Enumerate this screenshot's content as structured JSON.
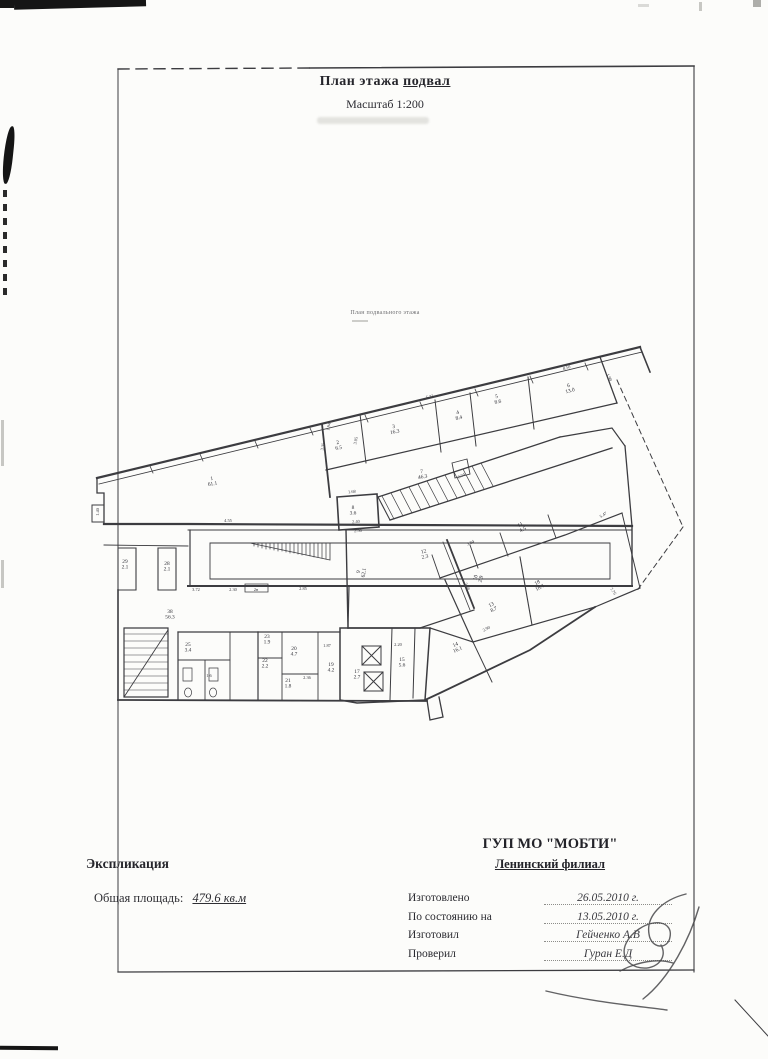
{
  "header": {
    "title_main": "План этажа",
    "title_floor": "подвал",
    "scale": "Масштаб 1:200",
    "plan_caption": "План подвального этажа"
  },
  "footer": {
    "explication": "Экспликация",
    "total_area_label": "Общая площадь:",
    "total_area_value": "479.6 кв.м",
    "org": "ГУП МО \"МОБТИ\"",
    "branch": "Ленинский филиал",
    "rows": [
      {
        "label": "Изготовлено",
        "value": "26.05.2010 г."
      },
      {
        "label": "По состоянию на",
        "value": "13.05.2010 г."
      },
      {
        "label": "Изготовил",
        "value": "Гейченко А.В"
      },
      {
        "label": "Проверил",
        "value": "Гуран Е.Д"
      }
    ]
  },
  "plan": {
    "rooms": [
      {
        "n": "1",
        "a": "61.1",
        "x": 212,
        "y": 480,
        "r": -8
      },
      {
        "n": "2",
        "a": "6.5",
        "x": 338,
        "y": 444,
        "r": -10
      },
      {
        "n": "3",
        "a": "16.3",
        "x": 394,
        "y": 428,
        "r": -11
      },
      {
        "n": "4",
        "a": "8.4",
        "x": 458,
        "y": 414,
        "r": -12
      },
      {
        "n": "5",
        "a": "8.6",
        "x": 497,
        "y": 398,
        "r": -13
      },
      {
        "n": "6",
        "a": "13.0",
        "x": 569,
        "y": 387,
        "r": -15
      },
      {
        "n": "7",
        "a": "46.3",
        "x": 422,
        "y": 473,
        "r": -10
      },
      {
        "n": "8",
        "a": "3.6",
        "x": 353,
        "y": 509,
        "r": 0
      },
      {
        "n": "9",
        "a": "62.1",
        "x": 360,
        "y": 572,
        "r": -80
      },
      {
        "n": "10",
        "a": "2.9",
        "x": 477,
        "y": 578,
        "r": -75
      },
      {
        "n": "11",
        "a": "4.5",
        "x": 521,
        "y": 526,
        "r": -28
      },
      {
        "n": "12",
        "a": "2.3",
        "x": 424,
        "y": 553,
        "r": -14
      },
      {
        "n": "13",
        "a": "8.7",
        "x": 492,
        "y": 606,
        "r": -28
      },
      {
        "n": "14",
        "a": "16.1",
        "x": 456,
        "y": 646,
        "r": -24
      },
      {
        "n": "18",
        "a": "18.1",
        "x": 538,
        "y": 584,
        "r": -28
      },
      {
        "n": "15",
        "a": "5.6",
        "x": 402,
        "y": 661,
        "r": 0
      },
      {
        "n": "17",
        "a": "2.7",
        "x": 357,
        "y": 673,
        "r": 0
      },
      {
        "n": "19",
        "a": "4.2",
        "x": 331,
        "y": 666,
        "r": 0
      },
      {
        "n": "20",
        "a": "4.7",
        "x": 294,
        "y": 650,
        "r": 0
      },
      {
        "n": "21",
        "a": "1.8",
        "x": 288,
        "y": 682,
        "r": 0
      },
      {
        "n": "22",
        "a": "2.2",
        "x": 265,
        "y": 662,
        "r": 0
      },
      {
        "n": "23",
        "a": "1.9",
        "x": 267,
        "y": 638,
        "r": 0
      },
      {
        "n": "25",
        "a": "3.4",
        "x": 188,
        "y": 646,
        "r": 0
      },
      {
        "n": "28",
        "a": "2.1",
        "x": 167,
        "y": 565,
        "r": 0
      },
      {
        "n": "29",
        "a": "2.1",
        "x": 125,
        "y": 563,
        "r": 0
      },
      {
        "n": "38",
        "a": "56.3",
        "x": 170,
        "y": 613,
        "r": 0
      }
    ],
    "dims": [
      {
        "t": "1.40",
        "x": 99,
        "y": 512,
        "r": -88
      },
      {
        "t": "4.55",
        "x": 228,
        "y": 522,
        "r": 0
      },
      {
        "t": "3.72",
        "x": 196,
        "y": 591,
        "r": 0
      },
      {
        "t": "2.30",
        "x": 233,
        "y": 591,
        "r": 0
      },
      {
        "t": "2н",
        "x": 256,
        "y": 591,
        "r": 0
      },
      {
        "t": "2.85",
        "x": 303,
        "y": 590,
        "r": 0
      },
      {
        "t": "1.94",
        "x": 330,
        "y": 427,
        "r": -78
      },
      {
        "t": "3.35",
        "x": 324,
        "y": 447,
        "r": -78
      },
      {
        "t": "3.05",
        "x": 357,
        "y": 441,
        "r": -78
      },
      {
        "t": "1.68",
        "x": 352,
        "y": 493,
        "r": -5
      },
      {
        "t": "2.40",
        "x": 356,
        "y": 523,
        "r": -3
      },
      {
        "t": "2.56",
        "x": 358,
        "y": 532,
        "r": -3
      },
      {
        "t": "8.04",
        "x": 462,
        "y": 477,
        "r": -27
      },
      {
        "t": "5.32",
        "x": 430,
        "y": 398,
        "r": -13
      },
      {
        "t": "8.50",
        "x": 567,
        "y": 369,
        "r": -17
      },
      {
        "t": "1.90",
        "x": 608,
        "y": 378,
        "r": 62
      },
      {
        "t": "3.84",
        "x": 471,
        "y": 544,
        "r": -25
      },
      {
        "t": "5.47",
        "x": 604,
        "y": 516,
        "r": -33
      },
      {
        "t": "3.88",
        "x": 466,
        "y": 587,
        "r": 62
      },
      {
        "t": "7.76",
        "x": 612,
        "y": 592,
        "r": 55
      },
      {
        "t": "2.90",
        "x": 487,
        "y": 630,
        "r": -28
      },
      {
        "t": "2.20",
        "x": 398,
        "y": 646,
        "r": 0
      },
      {
        "t": "1.87",
        "x": 327,
        "y": 647,
        "r": 0
      },
      {
        "t": "2.36",
        "x": 307,
        "y": 679,
        "r": 0
      },
      {
        "t": "1.6",
        "x": 209,
        "y": 677,
        "r": 0
      }
    ],
    "walls": [
      {
        "d": "M118,69 L310,68",
        "w": 1.4,
        "dash": "11,7",
        "c": "#585858"
      },
      {
        "d": "M310,68 L694,66",
        "w": 1.6,
        "c": "#4c4c4c"
      },
      {
        "d": "M694,66 L694,972",
        "w": 1.1,
        "c": "#7a7a78"
      },
      {
        "d": "M118,69 L118,972",
        "w": 1,
        "c": "#b8b8b4"
      },
      {
        "d": "M118,972 L694,970",
        "w": 1.3,
        "c": "#565656"
      },
      {
        "d": "M97,478 L640,347",
        "w": 2.2
      },
      {
        "d": "M99,484 L642,352",
        "w": 0.9
      },
      {
        "d": "M150,466 l3,7 M200,454 l3,7 M255,441 l3,7 M310,428 l3,7 M365,415 l3,7 M420,402 l3,7 M475,389 l3,7 M530,376 l3,7 M585,363 l3,7",
        "w": 0.8
      },
      {
        "d": "M640,347 L650,372",
        "w": 1.6
      },
      {
        "d": "M97,478 L97,493 L104,493 L104,524",
        "w": 1.3
      },
      {
        "d": "M92,505 L104,505 M92,505 L92,522 L104,522",
        "w": 1
      },
      {
        "d": "M104,524 L188,524 L632,526",
        "w": 2.2
      },
      {
        "d": "M188,530 L632,530",
        "w": 0.9
      },
      {
        "d": "M190,530 L190,586",
        "w": 1.2
      },
      {
        "d": "M188,586 L632,586",
        "w": 2
      },
      {
        "d": "M632,526 L632,586",
        "w": 1.4
      },
      {
        "d": "M210,543 L610,543 L610,579 L210,579 Z",
        "w": 0.9
      },
      {
        "d": "M250,543 L330,543 L330,560 Z",
        "w": 0.8
      },
      {
        "d": "M254,543 v3 M258,543 v4 M262,543 v5 M266,543 v6 M270,543 v6 M274,543 v7 M278,543 v8 M282,543 v8 M286,543 v9 M290,543 v10 M294,543 v10 M298,543 v11 M302,543 v12 M306,543 v12 M310,543 v13 M314,543 v14 M318,543 v14 M322,543 v15 M326,543 v16",
        "w": 0.7
      },
      {
        "d": "M245,584 L268,584 L268,592 L245,592 Z",
        "w": 0.8
      },
      {
        "d": "M104,545 L188,546",
        "w": 0.9
      },
      {
        "d": "M118,548 L136,548 L136,590 L118,590 Z",
        "w": 1.1
      },
      {
        "d": "M158,548 L176,548 L176,590 L158,590 Z",
        "w": 1.1
      },
      {
        "d": "M118,590 L118,700",
        "w": 1.6
      },
      {
        "d": "M118,700 L427,701",
        "w": 1.8
      },
      {
        "d": "M124,628 L168,628 L168,697 L124,697 Z",
        "w": 1.2
      },
      {
        "d": "M124,634 h44 M124,641 h44 M124,648 h44 M124,655 h44 M124,662 h44 M124,669 h44 M124,676 h44 M124,683 h44 M124,690 h44",
        "w": 0.6
      },
      {
        "d": "M124,697 L168,630",
        "w": 0.9
      },
      {
        "d": "M322,424 L330,497",
        "w": 1.8
      },
      {
        "d": "M326,470 L617,403",
        "w": 1.2
      },
      {
        "d": "M360,414 L366,463",
        "w": 1
      },
      {
        "d": "M435,400 L441,452",
        "w": 1
      },
      {
        "d": "M470,393 L476,446",
        "w": 1
      },
      {
        "d": "M528,377 L534,429",
        "w": 1
      },
      {
        "d": "M600,357 L617,403",
        "w": 1.3
      },
      {
        "d": "M452,463 L467,459 L470,474 L455,478 Z",
        "w": 0.9
      },
      {
        "d": "M337,497 L377,494 L379,527 L339,530 Z",
        "w": 1.6
      },
      {
        "d": "M378,497 L560,437",
        "w": 1.3
      },
      {
        "d": "M390,520 L612,448",
        "w": 1.3
      },
      {
        "d": "M378,497 L390,520",
        "w": 1.1
      },
      {
        "d": "M560,437 L612,428 L625,446",
        "w": 1.2
      },
      {
        "d": "M625,446 L632,526",
        "w": 1.3
      },
      {
        "d": "M382,496 l12,23 M391,493 l12,23 M400,490 l12,23 M409,487 l12,23 M418,484 l12,23 M427,481 l12,23 M436,478 l12,23 M445,475 l12,23 M454,472 l12,23 M463,469 l12,23 M472,466 l12,23 M481,463 l12,23",
        "w": 0.7
      },
      {
        "d": "M617,380 L683,527",
        "w": 1,
        "dash": "5,4"
      },
      {
        "d": "M683,527 L636,592",
        "w": 1,
        "dash": "5,4"
      },
      {
        "d": "M346,530 L348,628",
        "w": 1.4
      },
      {
        "d": "M348,628 L420,628",
        "w": 1.4
      },
      {
        "d": "M447,540 L474,608",
        "w": 1.8
      },
      {
        "d": "M443,542 L470,610",
        "w": 0.8
      },
      {
        "d": "M420,628 L474,610",
        "w": 1.2
      },
      {
        "d": "M349,586 L348,628",
        "w": 1.2
      },
      {
        "d": "M340,628 L430,628 L425,700 L357,703 L340,700 Z",
        "w": 1.5
      },
      {
        "d": "M392,628 L390,700",
        "w": 1
      },
      {
        "d": "M415,628 L413,698",
        "w": 1
      },
      {
        "d": "M427,700 L430,720 L443,717 L439,697",
        "w": 1.3
      },
      {
        "d": "M362,646 h19 v19 h-19 Z M362,646 l19,19 M381,646 l-19,19",
        "w": 1
      },
      {
        "d": "M364,672 h19 v19 h-19 Z M364,672 l19,19 M383,672 l-19,19",
        "w": 1
      },
      {
        "d": "M258,632 L340,632",
        "w": 1.2
      },
      {
        "d": "M258,632 L258,700",
        "w": 1.2
      },
      {
        "d": "M282,632 L282,700",
        "w": 0.9
      },
      {
        "d": "M318,632 L318,700",
        "w": 0.9
      },
      {
        "d": "M258,658 L282,658",
        "w": 0.9
      },
      {
        "d": "M282,674 L318,674",
        "w": 0.9
      },
      {
        "d": "M178,632 L258,632",
        "w": 1.2
      },
      {
        "d": "M178,632 L178,700",
        "w": 1.2
      },
      {
        "d": "M178,660 L230,660",
        "w": 0.9
      },
      {
        "d": "M205,660 L205,700",
        "w": 0.9
      },
      {
        "d": "M230,632 L230,700",
        "w": 0.9
      },
      {
        "d": "M183,668 h9 v13 h-9 Z",
        "w": 0.7
      },
      {
        "d": "M209,668 h9 v13 h-9 Z",
        "w": 0.7
      },
      {
        "d": "M188,688 a3.5,4.5 0 1,0 0.1,0",
        "w": 0.7
      },
      {
        "d": "M213,688 a3.5,4.5 0 1,0 0.1,0",
        "w": 0.7
      },
      {
        "d": "M425,700 L440,693 L530,650 L595,607",
        "w": 1.8
      },
      {
        "d": "M440,578 L565,535 L622,513",
        "w": 1.2
      },
      {
        "d": "M520,557 L532,625",
        "w": 1.1
      },
      {
        "d": "M622,513 L640,588",
        "w": 1
      },
      {
        "d": "M473,642 L595,607",
        "w": 1.2
      },
      {
        "d": "M445,580 L473,642",
        "w": 1.2
      },
      {
        "d": "M595,607 L640,588",
        "w": 1.2
      },
      {
        "d": "M430,628 L473,642",
        "w": 1.2
      },
      {
        "d": "M473,642 L492,682",
        "w": 1
      },
      {
        "d": "M432,555 L440,578",
        "w": 0.9
      },
      {
        "d": "M470,545 L478,568",
        "w": 0.9
      },
      {
        "d": "M500,533 L508,556",
        "w": 0.9
      },
      {
        "d": "M548,515 L556,538",
        "w": 0.9
      },
      {
        "d": "M735,1000 L768,1036",
        "w": 1,
        "c": "#c9c9c4"
      }
    ],
    "signature_paths": [
      "M686,894 C662,900 646,916 649,934 C651,949 668,950 670,937 C673,922 655,918 639,929 C620,942 619,961 637,967 C654,972 669,959 661,945",
      "M699,907 C690,938 670,978 643,999",
      "M546,991 C592,1002 638,1006 667,1010",
      "M620,971 C637,962 657,958 673,963"
    ]
  }
}
